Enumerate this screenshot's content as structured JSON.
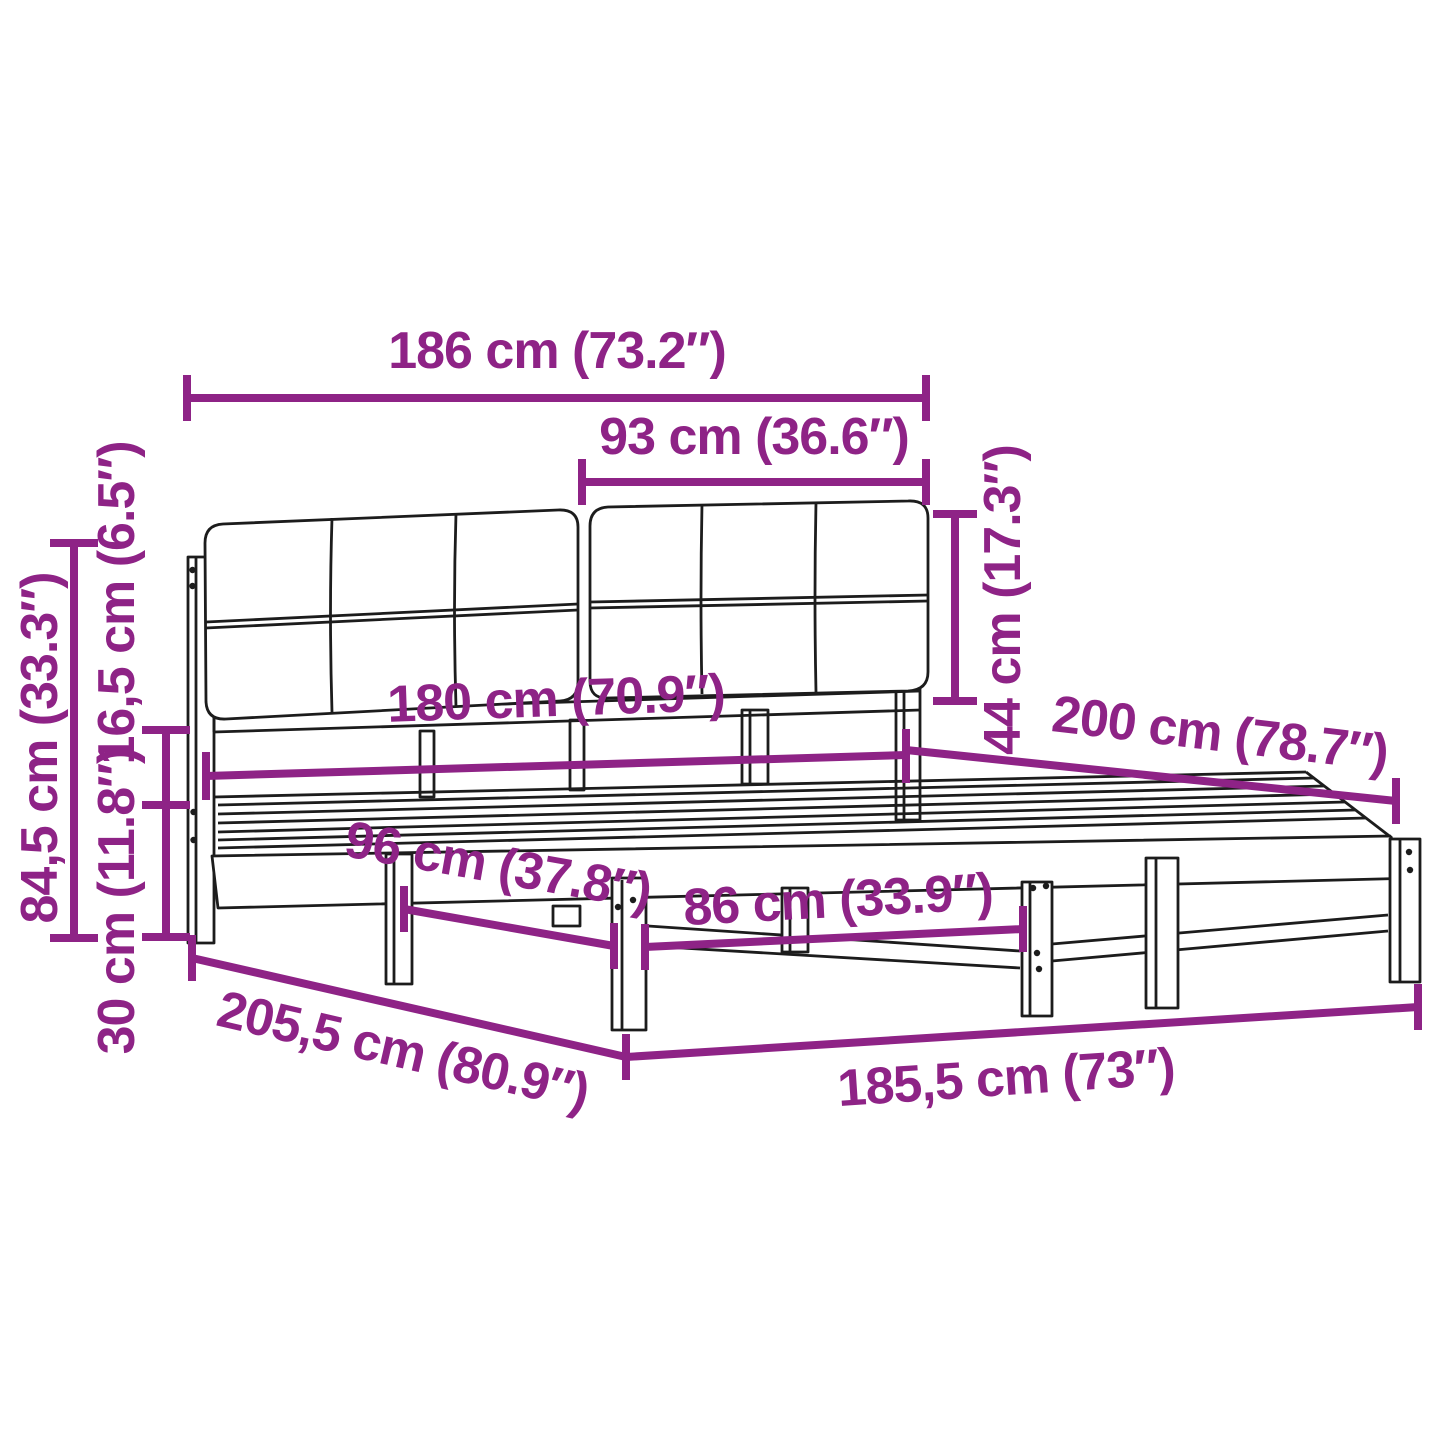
{
  "diagram": {
    "subject": "bed-frame-with-upholstered-headboard-dimension-diagram",
    "colors": {
      "accent": "#8e2386",
      "ink": "#1c1c1c",
      "bg": "#ffffff"
    },
    "labels": {
      "total_width": "186 cm (73.2″)",
      "headboard_half_width": "93 cm (36.6″)",
      "headboard_height": "44 cm (17.3″)",
      "bed_width": "180 cm (70.9″)",
      "bed_length": "200 cm (78.7″)",
      "total_height": "84,5 cm (33.3″)",
      "under_headboard_gap": "16,5 cm (6.5″)",
      "frame_height": "30 cm (11.8″)",
      "leg_spacing_side": "96 cm (37.8″)",
      "leg_spacing_front": "86 cm (33.9″)",
      "total_length": "205,5 cm (80.9″)",
      "frame_length": "185,5 cm (73″)"
    }
  }
}
